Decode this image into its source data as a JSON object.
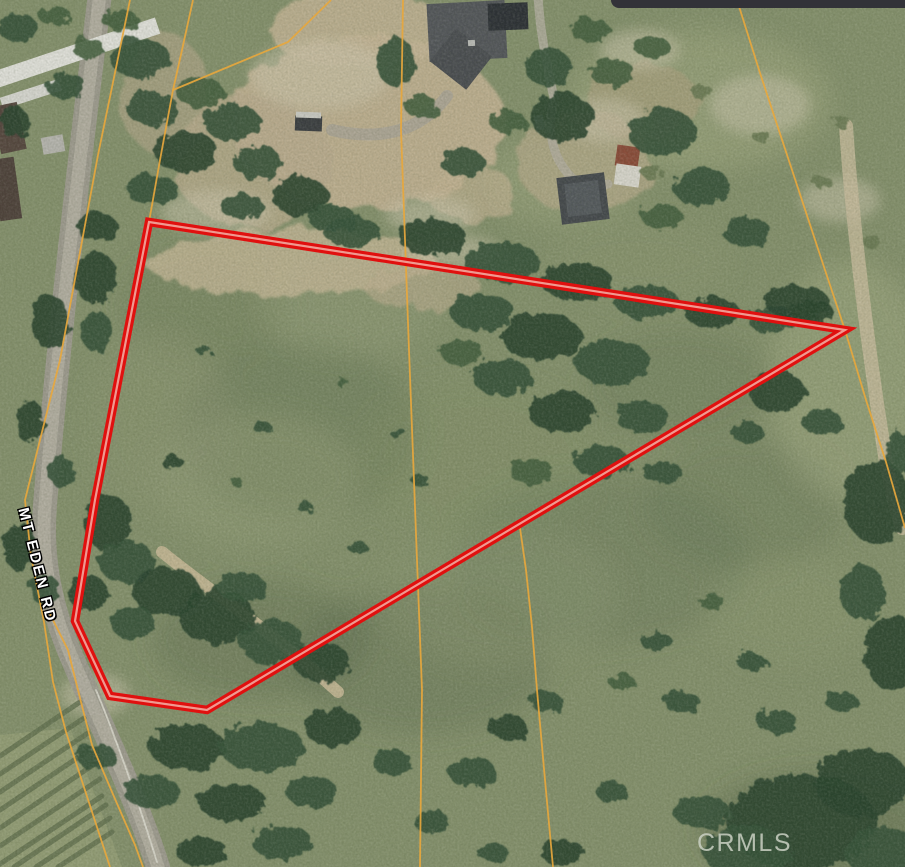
{
  "watermark": {
    "text": "CRMLS",
    "color": "#cbd1c4"
  },
  "road_label": {
    "text": "MT EDEN RD",
    "color": "#ffffff",
    "outline_color": "#000000"
  },
  "top_bar": {
    "color": "#323238"
  },
  "map": {
    "width": 905,
    "height": 867,
    "base_color": "#84906c",
    "tree_colors": [
      "#2a4430",
      "#36513b",
      "#45603f",
      "#6a7a54"
    ],
    "soft_mottles": [
      [
        300,
        430,
        120,
        90,
        "#5e6e50",
        0.3
      ],
      [
        600,
        560,
        150,
        85,
        "#5f6e51",
        0.28
      ],
      [
        420,
        660,
        130,
        75,
        "#5a694d",
        0.3
      ],
      [
        745,
        505,
        100,
        65,
        "#60704f",
        0.25
      ],
      [
        205,
        305,
        85,
        60,
        "#647251",
        0.25
      ],
      [
        680,
        385,
        95,
        55,
        "#616f4f",
        0.25
      ],
      [
        260,
        640,
        110,
        60,
        "#55654a",
        0.3
      ],
      [
        820,
        830,
        120,
        60,
        "#4f5f45",
        0.35
      ],
      [
        255,
        480,
        105,
        65,
        "#97a17b",
        0.4
      ],
      [
        500,
        595,
        120,
        70,
        "#8d9873",
        0.35
      ],
      [
        350,
        300,
        95,
        55,
        "#95a07b",
        0.35
      ],
      [
        790,
        610,
        85,
        55,
        "#8e9a74",
        0.3
      ],
      [
        560,
        180,
        75,
        45,
        "#a3a982",
        0.4
      ],
      [
        700,
        100,
        130,
        70,
        "#a2a981",
        0.5
      ],
      [
        850,
        380,
        80,
        120,
        "#a5ac85",
        0.45
      ],
      [
        160,
        420,
        70,
        90,
        "#8b9673",
        0.4
      ],
      [
        640,
        260,
        90,
        40,
        "#8d9870",
        0.3
      ],
      [
        480,
        460,
        120,
        80,
        "#828e68",
        0.35
      ]
    ],
    "pale_color": "#ccc6ae",
    "pale_patches": [
      [
        215,
        212,
        55,
        22
      ],
      [
        320,
        75,
        70,
        35
      ],
      [
        430,
        215,
        45,
        18
      ],
      [
        605,
        120,
        40,
        22
      ],
      [
        95,
        695,
        35,
        22
      ],
      [
        455,
        252,
        45,
        16
      ],
      [
        760,
        105,
        50,
        30
      ],
      [
        840,
        200,
        40,
        22
      ],
      [
        640,
        50,
        40,
        20
      ]
    ],
    "dirt_patches": [
      [
        368,
        122,
        135,
        88,
        "#bfb091",
        0.95
      ],
      [
        252,
        162,
        78,
        66,
        "#b9ab8d",
        0.8
      ],
      [
        290,
        262,
        145,
        34,
        "#c1b494",
        0.85
      ],
      [
        422,
        286,
        58,
        24,
        "#bcae90",
        0.6
      ],
      [
        585,
        162,
        68,
        52,
        "#b2a888",
        0.8
      ],
      [
        642,
        102,
        58,
        38,
        "#ac9f7e",
        0.6
      ],
      [
        470,
        192,
        44,
        28,
        "#c0b191",
        0.7
      ],
      [
        360,
        30,
        90,
        40,
        "#c3b495",
        0.85
      ],
      [
        165,
        95,
        45,
        60,
        "#b5a98c",
        0.6
      ]
    ],
    "paths": [
      {
        "d": "M 100,-6 C 82,140 58,340 45,505 C 41,555 49,600 68,648 C 92,707 132,785 158,867",
        "w": 24,
        "c": "#9e9b90",
        "o": 0.95
      },
      {
        "d": "M 100,-6 C 82,140 58,340 45,505 C 41,555 49,600 68,648 C 92,707 132,785 158,867",
        "w": 13,
        "c": "#b3afa3",
        "o": 0.9
      },
      {
        "d": "M 96,690 C 112,728 138,800 157,862",
        "w": 1.8,
        "c": "#e6e4da",
        "o": 0.75
      },
      {
        "d": "M 332,130 C 382,142 422,130 447,96",
        "w": 12,
        "c": "#a8a396",
        "o": 0.8
      },
      {
        "d": "M 538,-4 C 540,30 546,62 554,98",
        "w": 9,
        "c": "#b4afa2",
        "o": 0.8
      },
      {
        "d": "M 554,98 C 546,130 552,158 572,178 C 585,188 598,186 608,184",
        "w": 9,
        "c": "#b0ab9e",
        "o": 0.85
      },
      {
        "d": "M 162,552 C 215,595 268,628 338,692",
        "w": 12,
        "c": "#c6b897",
        "o": 0.9
      },
      {
        "d": "M 846,126 C 852,220 868,350 886,462 C 893,500 898,515 902,528",
        "w": 14,
        "c": "#c8bc9e",
        "o": 0.8
      }
    ],
    "orchard": {
      "area": "0,735 70,728 122,867 0,867",
      "area_color": "#939d77",
      "row_color": "#5e6d4c",
      "row_width": 5,
      "rows": [
        [
          0,
          756,
          80,
          702
        ],
        [
          0,
          774,
          84,
          718
        ],
        [
          0,
          792,
          88,
          733
        ],
        [
          0,
          810,
          92,
          748
        ],
        [
          0,
          828,
          96,
          763
        ],
        [
          0,
          846,
          100,
          779
        ],
        [
          0,
          864,
          102,
          796
        ],
        [
          14,
          867,
          106,
          805
        ],
        [
          36,
          867,
          110,
          818
        ],
        [
          58,
          867,
          112,
          832
        ]
      ]
    },
    "buildings": [
      [
        428,
        2,
        78,
        58,
        -3,
        "#53565a"
      ],
      [
        438,
        38,
        46,
        42,
        38,
        "#4a4d51"
      ],
      [
        488,
        3,
        40,
        27,
        -2,
        "#2d3136"
      ],
      [
        468,
        40,
        7,
        6,
        -3,
        "#b9bab6"
      ],
      [
        559,
        175,
        48,
        47,
        -7,
        "#45494d"
      ],
      [
        566,
        182,
        34,
        33,
        -7,
        "#54595d"
      ],
      [
        616,
        146,
        23,
        21,
        8,
        "#8a4c3a"
      ],
      [
        615,
        165,
        25,
        21,
        8,
        "#d7d5cc"
      ],
      [
        -8,
        44,
        170,
        17,
        -18.5,
        "#e0e0da"
      ],
      [
        0,
        88,
        62,
        12,
        -18,
        "#d6d6d0"
      ],
      [
        42,
        136,
        22,
        17,
        -10,
        "#b5b4ae"
      ],
      [
        -4,
        104,
        26,
        48,
        -12,
        "#55473f"
      ],
      [
        -4,
        158,
        22,
        62,
        -8,
        "#4e423b"
      ],
      [
        295,
        116,
        27,
        15,
        2,
        "#3b3e41"
      ],
      [
        296,
        112,
        25,
        6,
        2,
        "#c9c9c3"
      ],
      [
        535,
        115,
        9,
        15,
        -10,
        "#d8d7d1"
      ],
      [
        544,
        120,
        8,
        13,
        -10,
        "#c8c7c1"
      ]
    ],
    "trees": [
      [
        18,
        28,
        20,
        14,
        1
      ],
      [
        55,
        16,
        16,
        10,
        2
      ],
      [
        120,
        20,
        18,
        11,
        2
      ],
      [
        140,
        58,
        30,
        20,
        1
      ],
      [
        88,
        48,
        16,
        10,
        2
      ],
      [
        66,
        86,
        20,
        13,
        1
      ],
      [
        14,
        122,
        14,
        16,
        0
      ],
      [
        152,
        108,
        26,
        17,
        1
      ],
      [
        200,
        92,
        24,
        15,
        2
      ],
      [
        232,
        122,
        28,
        19,
        1
      ],
      [
        186,
        152,
        32,
        21,
        0
      ],
      [
        152,
        190,
        26,
        15,
        1
      ],
      [
        97,
        227,
        20,
        15,
        0
      ],
      [
        257,
        162,
        24,
        17,
        1
      ],
      [
        300,
        196,
        28,
        19,
        0
      ],
      [
        242,
        206,
        22,
        13,
        1
      ],
      [
        332,
        218,
        24,
        13,
        1
      ],
      [
        95,
        277,
        22,
        26,
        0
      ],
      [
        50,
        322,
        18,
        28,
        0
      ],
      [
        97,
        332,
        16,
        20,
        1
      ],
      [
        30,
        422,
        14,
        22,
        0
      ],
      [
        62,
        472,
        13,
        16,
        1
      ],
      [
        20,
        547,
        16,
        24,
        0
      ],
      [
        107,
        522,
        24,
        28,
        0
      ],
      [
        127,
        562,
        28,
        22,
        1
      ],
      [
        87,
        592,
        20,
        18,
        0
      ],
      [
        45,
        590,
        14,
        16,
        1
      ],
      [
        396,
        62,
        20,
        24,
        1
      ],
      [
        422,
        107,
        16,
        12,
        2
      ],
      [
        462,
        162,
        22,
        14,
        1
      ],
      [
        508,
        122,
        18,
        12,
        2
      ],
      [
        548,
        67,
        24,
        18,
        1
      ],
      [
        562,
        117,
        32,
        24,
        0
      ],
      [
        612,
        72,
        22,
        14,
        2
      ],
      [
        652,
        47,
        18,
        11,
        2
      ],
      [
        662,
        132,
        34,
        24,
        1
      ],
      [
        702,
        187,
        28,
        20,
        1
      ],
      [
        747,
        232,
        24,
        15,
        1
      ],
      [
        662,
        217,
        20,
        13,
        2
      ],
      [
        590,
        30,
        20,
        12,
        2
      ],
      [
        352,
        232,
        28,
        15,
        1
      ],
      [
        432,
        237,
        34,
        18,
        0
      ],
      [
        502,
        262,
        38,
        20,
        1
      ],
      [
        577,
        282,
        36,
        19,
        0
      ],
      [
        647,
        302,
        32,
        17,
        1
      ],
      [
        712,
        312,
        28,
        15,
        0
      ],
      [
        772,
        320,
        24,
        13,
        1
      ],
      [
        812,
        312,
        22,
        12,
        0
      ],
      [
        482,
        312,
        32,
        19,
        1
      ],
      [
        542,
        337,
        40,
        24,
        0
      ],
      [
        612,
        362,
        38,
        22,
        1
      ],
      [
        502,
        377,
        30,
        18,
        1
      ],
      [
        562,
        412,
        34,
        20,
        0
      ],
      [
        642,
        417,
        26,
        16,
        1
      ],
      [
        462,
        352,
        22,
        13,
        2
      ],
      [
        602,
        462,
        28,
        16,
        1
      ],
      [
        532,
        472,
        22,
        13,
        2
      ],
      [
        662,
        472,
        20,
        11,
        1
      ],
      [
        205,
        352,
        7,
        5,
        1
      ],
      [
        262,
        427,
        9,
        6,
        1
      ],
      [
        172,
        462,
        11,
        7,
        0
      ],
      [
        305,
        507,
        8,
        5,
        1
      ],
      [
        237,
        482,
        6,
        4,
        2
      ],
      [
        357,
        547,
        10,
        6,
        1
      ],
      [
        397,
        432,
        8,
        5,
        1
      ],
      [
        342,
        382,
        6,
        4,
        2
      ],
      [
        420,
        480,
        9,
        6,
        1
      ],
      [
        167,
        592,
        34,
        25,
        0
      ],
      [
        217,
        617,
        38,
        27,
        0
      ],
      [
        272,
        642,
        32,
        23,
        1
      ],
      [
        322,
        662,
        28,
        20,
        0
      ],
      [
        132,
        622,
        22,
        17,
        1
      ],
      [
        242,
        587,
        24,
        15,
        1
      ],
      [
        187,
        747,
        38,
        23,
        0
      ],
      [
        262,
        747,
        42,
        25,
        1
      ],
      [
        332,
        727,
        28,
        19,
        0
      ],
      [
        152,
        792,
        28,
        17,
        1
      ],
      [
        232,
        802,
        34,
        19,
        0
      ],
      [
        312,
        792,
        26,
        15,
        1
      ],
      [
        97,
        757,
        20,
        13,
        1
      ],
      [
        392,
        762,
        20,
        13,
        1
      ],
      [
        282,
        842,
        30,
        17,
        1
      ],
      [
        202,
        852,
        26,
        14,
        0
      ],
      [
        472,
        772,
        24,
        15,
        1
      ],
      [
        507,
        727,
        20,
        12,
        0
      ],
      [
        547,
        702,
        16,
        10,
        1
      ],
      [
        432,
        822,
        18,
        11,
        1
      ],
      [
        562,
        852,
        22,
        13,
        0
      ],
      [
        612,
        792,
        16,
        10,
        1
      ],
      [
        492,
        852,
        16,
        9,
        1
      ],
      [
        657,
        642,
        16,
        9,
        1
      ],
      [
        712,
        602,
        13,
        8,
        2
      ],
      [
        752,
        662,
        15,
        9,
        1
      ],
      [
        682,
        702,
        18,
        11,
        1
      ],
      [
        622,
        682,
        13,
        8,
        2
      ],
      [
        777,
        722,
        20,
        12,
        1
      ],
      [
        842,
        702,
        16,
        10,
        1
      ],
      [
        802,
        822,
        75,
        48,
        0
      ],
      [
        862,
        782,
        48,
        34,
        0
      ],
      [
        747,
        852,
        44,
        26,
        1
      ],
      [
        882,
        852,
        38,
        25,
        1
      ],
      [
        702,
        812,
        28,
        17,
        1
      ],
      [
        877,
        502,
        33,
        42,
        0
      ],
      [
        892,
        652,
        28,
        38,
        0
      ],
      [
        862,
        592,
        22,
        28,
        1
      ],
      [
        902,
        452,
        16,
        20,
        1
      ],
      [
        797,
        302,
        32,
        17,
        0
      ],
      [
        777,
        392,
        28,
        21,
        0
      ],
      [
        822,
        422,
        20,
        13,
        1
      ],
      [
        747,
        432,
        16,
        11,
        1
      ],
      [
        702,
        92,
        11,
        7,
        3
      ],
      [
        762,
        137,
        9,
        6,
        3
      ],
      [
        822,
        182,
        10,
        6,
        3
      ],
      [
        872,
        242,
        9,
        6,
        3
      ],
      [
        652,
        172,
        11,
        7,
        3
      ],
      [
        842,
        122,
        8,
        5,
        3
      ]
    ],
    "parcel_lines": {
      "color": "#e7a73d",
      "width": 1.8,
      "lines": [
        "130,0 98,155 60,360 25,500 31,556 44,622 53,682 66,732 110,867",
        "48,610 68,650 82,706 92,745 112,792 135,845 143,867",
        "193,0 182,50 173,90 160,160 149,222",
        "173,90 288,42 331,0",
        "403,0 401,130 409,350 417,560 422,690 420,867",
        "737,0 760,73 825,270 845,330 866,400 886,462 905,528",
        "520,528 526,570 532,627 537,690 545,780 553,867"
      ]
    },
    "highlight_parcel": {
      "points": "149,222 845,330 207,710 110,696 75,621 95,500 128,330",
      "outer_color": "#e0100f",
      "outer_width": 8.5,
      "inner_color": "#f2a99e",
      "inner_width": 2.2
    }
  }
}
